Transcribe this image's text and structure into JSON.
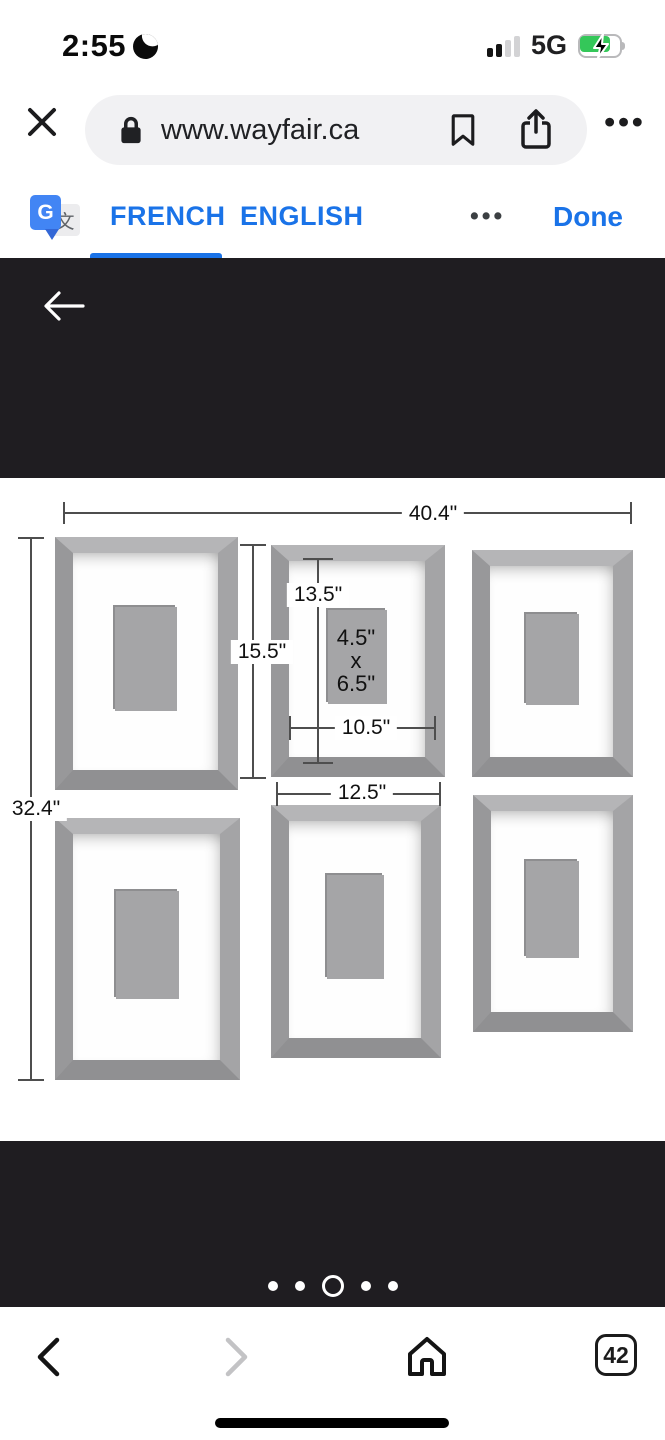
{
  "status_bar": {
    "time": "2:55",
    "network": "5G",
    "charging": true
  },
  "browser": {
    "url": "www.wayfair.ca",
    "more_label": "•••"
  },
  "translate_bar": {
    "icon_g": "G",
    "icon_char": "文",
    "source_lang": "FRENCH",
    "target_lang": "ENGLISH",
    "more_label": "•••",
    "done_label": "Done"
  },
  "product_diagram": {
    "total_width": "40.4\"",
    "total_height": "32.4\"",
    "frame_height": "15.5\"",
    "opening_height": "13.5\"",
    "photo_size": [
      "4.5\"",
      "x",
      "6.5\""
    ],
    "opening_width": "10.5\"",
    "frame_width": "12.5\""
  },
  "carousel": {
    "count": 5,
    "active_index": 2
  },
  "bottom_nav": {
    "tab_count": "42"
  },
  "colors": {
    "accent_blue": "#1a73e8",
    "translate_icon_blue": "#4285f4",
    "dark_background": "#1f1d21",
    "battery_green": "#34c759",
    "frame_gray": "#a4a4a6",
    "photo_gray": "#a5a5a7",
    "omnibox_gray": "#f1f1f3"
  }
}
